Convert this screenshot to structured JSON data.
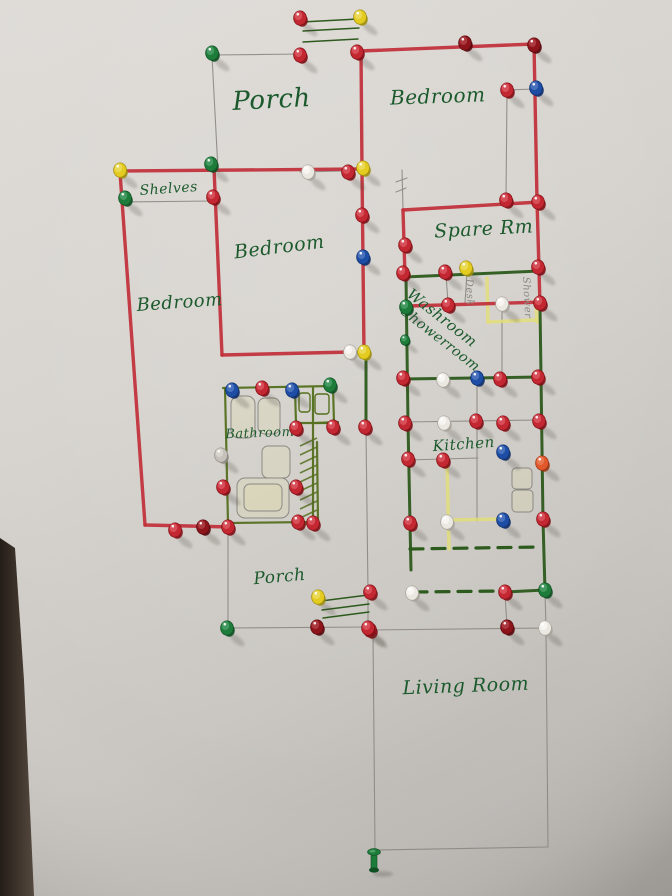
{
  "canvas": {
    "width": 672,
    "height": 896
  },
  "palette": {
    "ink_green": "#1c5a2d",
    "pencil": "#8b8883",
    "marker_red": "#c2303a",
    "marker_green": "#2d5a1d",
    "marker_olive": "#55701f",
    "highlighter": "#e4df76",
    "board": "#d6d3ce",
    "edge_dark": "#2a231d",
    "pins": {
      "r": {
        "fill": "#c32731",
        "light": "#e8737a",
        "dark": "#801016"
      },
      "d": {
        "fill": "#8d141a",
        "light": "#c4555c",
        "dark": "#57080c"
      },
      "g": {
        "fill": "#1e7c3a",
        "light": "#63b07e",
        "dark": "#0f4f22"
      },
      "y": {
        "fill": "#e3cb20",
        "light": "#f3e781",
        "dark": "#a08f0e"
      },
      "b": {
        "fill": "#1d4da5",
        "light": "#6f8fd0",
        "dark": "#0f2e6b"
      },
      "w": {
        "fill": "#ebe8e2",
        "light": "#ffffff",
        "dark": "#a8a49c"
      },
      "o": {
        "fill": "#e0582c",
        "light": "#f0936f",
        "dark": "#9c3413"
      },
      "s": {
        "fill": "#c6c2bb",
        "light": "#e8e5df",
        "dark": "#908c85"
      }
    }
  },
  "labels": [
    {
      "id": "porch-top",
      "text": "Porch",
      "x": 272,
      "y": 108,
      "size": 26,
      "rotate": -3,
      "anchor": "middle"
    },
    {
      "id": "bedroom-top-right",
      "text": "Bedroom",
      "x": 438,
      "y": 103,
      "size": 20,
      "rotate": -2,
      "anchor": "middle"
    },
    {
      "id": "shelves",
      "text": "Shelves",
      "x": 169,
      "y": 193,
      "size": 14,
      "rotate": -4,
      "anchor": "middle"
    },
    {
      "id": "bedroom-middle",
      "text": "Bedroom",
      "x": 280,
      "y": 253,
      "size": 19,
      "rotate": -7,
      "anchor": "middle"
    },
    {
      "id": "bedroom-left",
      "text": "Bedroom",
      "x": 180,
      "y": 308,
      "size": 18,
      "rotate": -4,
      "anchor": "middle"
    },
    {
      "id": "spare-rm",
      "text": "Spare Rm",
      "x": 484,
      "y": 235,
      "size": 19,
      "rotate": -3,
      "anchor": "middle"
    },
    {
      "id": "washroom",
      "text": "Washroom",
      "x": 406,
      "y": 296,
      "size": 15,
      "rotate": 38,
      "anchor": "start"
    },
    {
      "id": "showerroom",
      "text": "Showerroom",
      "x": 400,
      "y": 313,
      "size": 14,
      "rotate": 38,
      "anchor": "start"
    },
    {
      "id": "bathroom",
      "text": "Bathroom",
      "x": 260,
      "y": 437,
      "size": 13,
      "rotate": -2,
      "anchor": "middle"
    },
    {
      "id": "kitchen",
      "text": "Kitchen",
      "x": 464,
      "y": 449,
      "size": 15,
      "rotate": -4,
      "anchor": "middle"
    },
    {
      "id": "porch-bottom",
      "text": "Porch",
      "x": 280,
      "y": 582,
      "size": 17,
      "rotate": -5,
      "anchor": "middle"
    },
    {
      "id": "living-room",
      "text": "Living Room",
      "x": 466,
      "y": 692,
      "size": 19,
      "rotate": -2,
      "anchor": "middle"
    }
  ],
  "pencil_labels": [
    {
      "id": "desk-note",
      "text": "Desk",
      "x": 466,
      "y": 279,
      "size": 10,
      "rotate": 87
    },
    {
      "id": "shower-note",
      "text": "Shower",
      "x": 523,
      "y": 277,
      "size": 10,
      "rotate": 87
    }
  ],
  "walls": {
    "red": [
      [
        360,
        51,
        534,
        44
      ],
      [
        534,
        44,
        537,
        200
      ],
      [
        537,
        200,
        540,
        305
      ],
      [
        361,
        50,
        362,
        171
      ],
      [
        362,
        171,
        364,
        352
      ],
      [
        120,
        171,
        362,
        169
      ],
      [
        120,
        172,
        145,
        525
      ],
      [
        145,
        525,
        232,
        527
      ],
      [
        214,
        168,
        222,
        355
      ],
      [
        222,
        355,
        352,
        352
      ],
      [
        403,
        210,
        540,
        202
      ],
      [
        403,
        210,
        405,
        276
      ],
      [
        408,
        306,
        545,
        302
      ]
    ],
    "green": [
      [
        405,
        277,
        540,
        271
      ],
      [
        406,
        277,
        408,
        423
      ],
      [
        408,
        423,
        410,
        523
      ],
      [
        410,
        523,
        411,
        570
      ],
      [
        540,
        305,
        543,
        520
      ],
      [
        543,
        520,
        545,
        591
      ],
      [
        403,
        379,
        540,
        377
      ],
      [
        505,
        592,
        545,
        590
      ],
      [
        366,
        356,
        366,
        424
      ]
    ],
    "olive": [
      [
        223,
        388,
        333,
        386
      ],
      [
        225,
        388,
        228,
        523
      ],
      [
        228,
        523,
        313,
        522
      ],
      [
        313,
        388,
        313,
        522
      ],
      [
        333,
        386,
        334,
        423
      ],
      [
        295,
        390,
        296,
        423
      ],
      [
        296,
        423,
        334,
        423
      ],
      [
        317,
        442,
        318,
        522
      ],
      [
        316,
        423,
        338,
        422
      ]
    ],
    "pencil": [
      [
        212,
        55,
        302,
        54
      ],
      [
        212,
        56,
        218,
        170
      ],
      [
        300,
        172,
        345,
        171
      ],
      [
        125,
        202,
        213,
        201
      ],
      [
        507,
        92,
        506,
        198
      ],
      [
        507,
        90,
        534,
        89
      ],
      [
        402,
        170,
        403,
        209
      ],
      [
        396,
        182,
        407,
        178
      ],
      [
        396,
        192,
        406,
        188
      ],
      [
        446,
        274,
        448,
        303
      ],
      [
        467,
        272,
        465,
        303
      ],
      [
        502,
        307,
        502,
        377
      ],
      [
        477,
        380,
        477,
        521
      ],
      [
        405,
        422,
        539,
        420
      ],
      [
        408,
        460,
        478,
        458
      ],
      [
        228,
        530,
        228,
        628
      ],
      [
        228,
        628,
        370,
        627
      ],
      [
        368,
        600,
        368,
        628
      ],
      [
        366,
        430,
        368,
        592
      ],
      [
        370,
        630,
        546,
        628
      ],
      [
        373,
        631,
        375,
        850
      ],
      [
        375,
        850,
        548,
        847
      ],
      [
        546,
        629,
        548,
        847
      ],
      [
        545,
        592,
        546,
        628
      ],
      [
        505,
        594,
        507,
        626
      ]
    ],
    "dashed": [
      [
        410,
        549,
        540,
        547
      ],
      [
        414,
        592,
        502,
        591
      ]
    ],
    "yellow": [
      [
        487,
        278,
        488,
        322
      ],
      [
        488,
        322,
        536,
        320
      ],
      [
        536,
        300,
        537,
        322
      ],
      [
        447,
        462,
        449,
        549
      ],
      [
        449,
        520,
        502,
        519
      ]
    ],
    "steps": [
      [
        302,
        22,
        358,
        19
      ],
      [
        303,
        31,
        359,
        28
      ],
      [
        303,
        42,
        358,
        39
      ],
      [
        321,
        601,
        368,
        595
      ],
      [
        322,
        610,
        369,
        604
      ],
      [
        323,
        618,
        369,
        612
      ]
    ]
  },
  "sketches": {
    "pencil_rects": [
      [
        231,
        396,
        24,
        42,
        8
      ],
      [
        258,
        398,
        22,
        36,
        7
      ],
      [
        262,
        446,
        28,
        32,
        6
      ],
      [
        237,
        478,
        52,
        40,
        8
      ],
      [
        244,
        484,
        38,
        27,
        6
      ],
      [
        512,
        468,
        20,
        21,
        4
      ],
      [
        512,
        490,
        21,
        22,
        4
      ]
    ],
    "green_rects": [
      [
        299,
        393,
        11,
        19,
        3
      ],
      [
        315,
        394,
        14,
        20,
        3
      ]
    ],
    "hatch": {
      "x": 300,
      "y": 440,
      "w": 17,
      "h": 82,
      "step": 9
    },
    "yellow_box": [
      478,
      277,
      59,
      45
    ]
  },
  "pins": [
    [
      300,
      18,
      "r"
    ],
    [
      360,
      17,
      "y"
    ],
    [
      300,
      55,
      "r"
    ],
    [
      357,
      52,
      "r"
    ],
    [
      212,
      53,
      "g"
    ],
    [
      465,
      43,
      "d"
    ],
    [
      534,
      45,
      "d"
    ],
    [
      507,
      90,
      "r"
    ],
    [
      536,
      88,
      "b"
    ],
    [
      120,
      170,
      "y"
    ],
    [
      211,
      164,
      "g"
    ],
    [
      125,
      198,
      "g"
    ],
    [
      213,
      197,
      "r"
    ],
    [
      308,
      172,
      "w"
    ],
    [
      348,
      172,
      "r"
    ],
    [
      363,
      168,
      "y"
    ],
    [
      362,
      215,
      "r"
    ],
    [
      363,
      257,
      "b"
    ],
    [
      506,
      200,
      "r"
    ],
    [
      538,
      202,
      "r"
    ],
    [
      405,
      245,
      "r"
    ],
    [
      403,
      273,
      "r"
    ],
    [
      445,
      272,
      "r"
    ],
    [
      466,
      268,
      "y"
    ],
    [
      538,
      267,
      "r"
    ],
    [
      406,
      307,
      "g"
    ],
    [
      448,
      305,
      "r"
    ],
    [
      502,
      304,
      "w"
    ],
    [
      540,
      303,
      "r"
    ],
    [
      405,
      340,
      "g",
      "small"
    ],
    [
      350,
      352,
      "w"
    ],
    [
      364,
      352,
      "y"
    ],
    [
      403,
      378,
      "r"
    ],
    [
      443,
      380,
      "w"
    ],
    [
      477,
      378,
      "b"
    ],
    [
      500,
      379,
      "r"
    ],
    [
      538,
      377,
      "r"
    ],
    [
      405,
      423,
      "r"
    ],
    [
      444,
      423,
      "w"
    ],
    [
      476,
      421,
      "r"
    ],
    [
      503,
      423,
      "r"
    ],
    [
      539,
      421,
      "r"
    ],
    [
      232,
      390,
      "b"
    ],
    [
      262,
      388,
      "r"
    ],
    [
      292,
      390,
      "b"
    ],
    [
      330,
      385,
      "g"
    ],
    [
      221,
      455,
      "s"
    ],
    [
      223,
      487,
      "r"
    ],
    [
      296,
      428,
      "r"
    ],
    [
      296,
      487,
      "r"
    ],
    [
      298,
      522,
      "r"
    ],
    [
      313,
      523,
      "r"
    ],
    [
      333,
      427,
      "r"
    ],
    [
      365,
      427,
      "r"
    ],
    [
      175,
      530,
      "r"
    ],
    [
      203,
      527,
      "d"
    ],
    [
      228,
      527,
      "r"
    ],
    [
      503,
      452,
      "b"
    ],
    [
      408,
      459,
      "r"
    ],
    [
      443,
      460,
      "r"
    ],
    [
      542,
      463,
      "o"
    ],
    [
      410,
      523,
      "r"
    ],
    [
      447,
      522,
      "w"
    ],
    [
      503,
      520,
      "b"
    ],
    [
      543,
      519,
      "r"
    ],
    [
      412,
      593,
      "w"
    ],
    [
      505,
      592,
      "r"
    ],
    [
      545,
      590,
      "g"
    ],
    [
      507,
      627,
      "d"
    ],
    [
      545,
      628,
      "w"
    ],
    [
      370,
      630,
      "r"
    ],
    [
      318,
      597,
      "y"
    ],
    [
      370,
      592,
      "r"
    ],
    [
      317,
      627,
      "d"
    ],
    [
      368,
      628,
      "r"
    ],
    [
      227,
      628,
      "g"
    ]
  ],
  "standing_pin": {
    "x": 374,
    "y": 858,
    "color": "g"
  }
}
